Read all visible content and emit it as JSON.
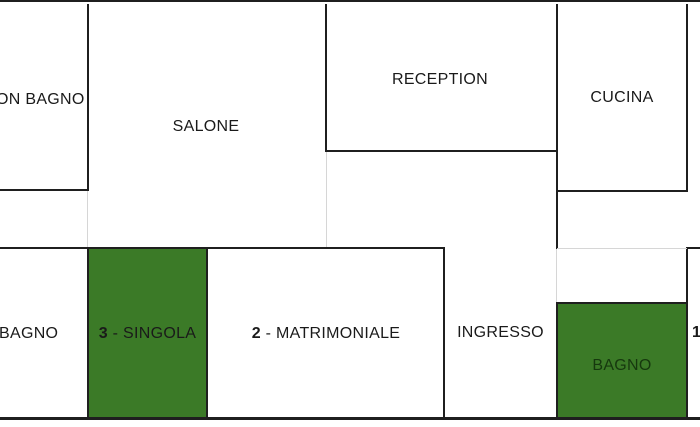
{
  "plan": {
    "colors": {
      "background": "#ffffff",
      "wall": "#1f1f1f",
      "faint": "#d6d6d6",
      "ink": "#1a1a1a",
      "green": "#3b7a27",
      "green_ink": "#16380e"
    },
    "rooms": {
      "con_bagno": {
        "label": "ON BAGNO"
      },
      "salone": {
        "label": "SALONE"
      },
      "reception": {
        "label": "RECEPTION"
      },
      "cucina": {
        "label": "CUCINA"
      },
      "bagno_left": {
        "label": "BAGNO"
      },
      "singola": {
        "number": "3",
        "name": " - SINGOLA"
      },
      "matrimoniale": {
        "number": "2",
        "name": " - MATRIMONIALE"
      },
      "ingresso": {
        "label": "INGRESSO"
      },
      "bagno_verde": {
        "label": "BAGNO"
      },
      "camera_right": {
        "number": "1"
      }
    }
  }
}
